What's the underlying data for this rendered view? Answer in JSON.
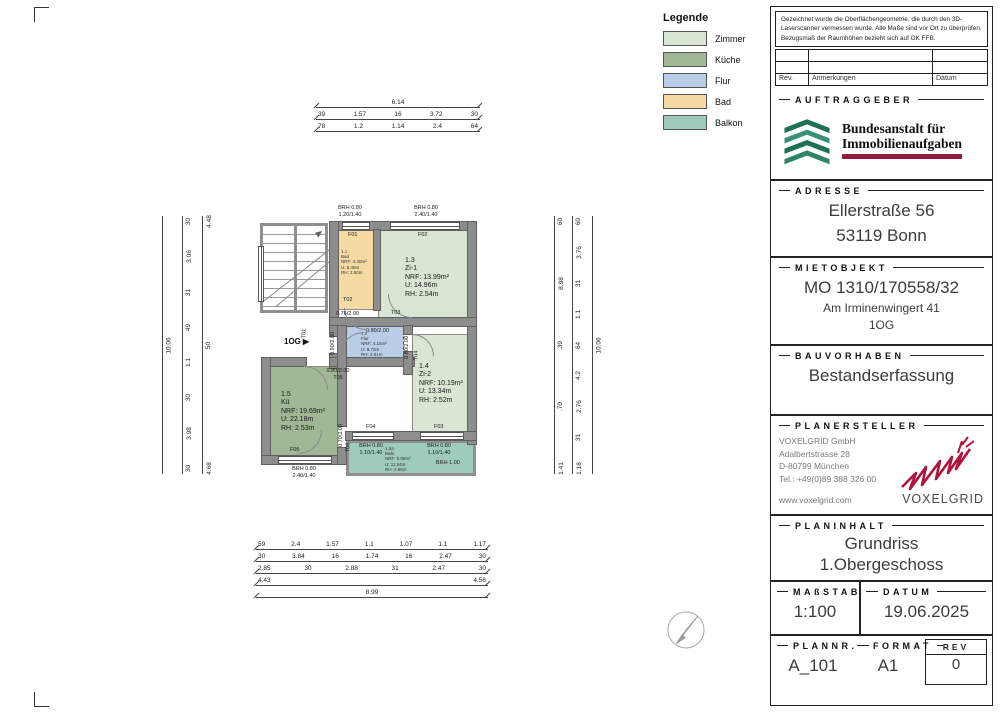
{
  "legend": {
    "title": "Legende",
    "items": [
      {
        "label": "Zimmer",
        "color": "#d9e6d3"
      },
      {
        "label": "Küche",
        "color": "#a1b795"
      },
      {
        "label": "Flur",
        "color": "#b9cde6"
      },
      {
        "label": "Bad",
        "color": "#f5dba3"
      },
      {
        "label": "Balkon",
        "color": "#9fcbbd"
      }
    ]
  },
  "note": {
    "text": "Gezeichnet wurde die Oberflächengeometrie, die durch den 3D-Laserscanner vermessen wurde. Alle Maße sind vor Ort zu überprüfen. Bezugsmaß der Raumhöhen bezieht sich auf OK FFB.",
    "rev": "Rev.",
    "anmerkungen": "Anmerkungen",
    "datum": "Datum"
  },
  "titleblock": {
    "auftraggeber": {
      "heading": "AUFTRAGGEBER",
      "logo_line1": "Bundesanstalt für",
      "logo_line2": "Immobilienaufgaben"
    },
    "adresse": {
      "heading": "ADRESSE",
      "line1": "Ellerstraße 56",
      "line2": "53119 Bonn"
    },
    "mietobjekt": {
      "heading": "MIETOBJEKT",
      "line1": "MO 1310/170558/32",
      "line2": "Am Irminenwingert 41",
      "line3": "1OG"
    },
    "bauvorhaben": {
      "heading": "BAUVORHABEN",
      "line1": "Bestandserfassung"
    },
    "planersteller": {
      "heading": "PLANERSTELLER",
      "company": "VOXELGRID GmbH",
      "street": "Adalbertstrasse 28",
      "city": "D-80799 München",
      "tel": "Tel.: +49(0)89 388 326 00",
      "web": "www.voxelgrid.com",
      "logo_text": "VOXELGRID"
    },
    "planinhalt": {
      "heading": "PLANINHALT",
      "line1": "Grundriss",
      "line2": "1.Obergeschoss"
    },
    "massstab": {
      "heading": "MAßSTAB",
      "value": "1:100"
    },
    "datum": {
      "heading": "DATUM",
      "value": "19.06.2025"
    },
    "plannr": {
      "heading": "PLANNR.",
      "value": "A_101"
    },
    "format": {
      "heading": "FORMAT",
      "value": "A1"
    },
    "rev": {
      "heading": "REV",
      "value": "0"
    }
  },
  "plan": {
    "floor_tag": "1OG",
    "rooms": {
      "zi1": "1.3\nZi-1\nNRF: 13.99m²\nU: 14.96m\nRH: 2.54m",
      "zi2": "1.4\nZi-2\nNRF: 10.19m²\nU: 13.34m\nRH: 2.52m",
      "kueche": "1.5\nKü\nNRF: 19.69m²\nU: 22.18m\nRH: 2.53m",
      "bad": "1.1\nBad\nNRF: 4.30m²\nU: 8.40m\nRH: 2.50m",
      "flur": "1.2\nFlur\nNRF: 4.15m²\nU: 8.70m\nRH: 2.51m",
      "balkon": "1.5a\nBalk.\nNRF: 6.08m²\nU: 11.54m\nRH: 2.56m"
    },
    "doors": {
      "t01": "T01",
      "t02": "T02",
      "t03": "T03",
      "t04": "T04",
      "t05": "T05",
      "t06": "T06",
      "size_t02": "0.76/2.00",
      "size_t03": "0.80/2.00",
      "size_t04": "0.80/2.00",
      "size_t05": "0.80/2.00",
      "size_t06": "0.70/2.00",
      "size_entry": "0.90/2.00"
    },
    "windows": {
      "f01": "F01",
      "f02": "F02",
      "f03": "F03",
      "f04": "F04",
      "f05": "F05",
      "brh_f01": "BRH 0.80\n1.20/1.40",
      "brh_f02": "BRH 0.80\n2.40/1.40",
      "brh_f03": "BRH 0.80\n1.10/1.40",
      "brh_f04": "BRH 0.80\n1.10/1.40",
      "brh_f05": "BRH 0.80\n2.40/1.40",
      "brh_balkon": "BRH 1.00"
    },
    "dims": {
      "top": {
        "total": "6.14",
        "row2": [
          "39",
          "1.57",
          "16",
          "3.72",
          "30"
        ],
        "row3": [
          "78",
          "1.2",
          "1.14",
          "2.4",
          "64"
        ]
      },
      "left": {
        "outer": "10.06",
        "col1": [
          "30",
          "3.06",
          "31",
          "49",
          "1.1",
          "30",
          "3.98",
          "30"
        ],
        "col2": [
          "4.48",
          "50",
          "4.68"
        ]
      },
      "right": {
        "col1": [
          "60",
          "8.98",
          ".39",
          ".70",
          "1.41"
        ],
        "col2": [
          "60",
          "3.76",
          "31",
          "1.1",
          "64",
          "4.2",
          "2.76",
          "31",
          "1.18"
        ],
        "outer": "10.06"
      },
      "bottom": {
        "row1": [
          "59",
          "2.4",
          "1.57",
          "1.1",
          "1.07",
          "1.1",
          "1.17"
        ],
        "row2": [
          "30",
          "3.84",
          "16",
          "1.74",
          "16",
          "2.47",
          "30"
        ],
        "row3": [
          "2.85",
          "30",
          "2.88",
          "31",
          "2.47",
          "30"
        ],
        "row4": [
          "4.43",
          "4.56"
        ],
        "total": "8.99"
      }
    }
  }
}
